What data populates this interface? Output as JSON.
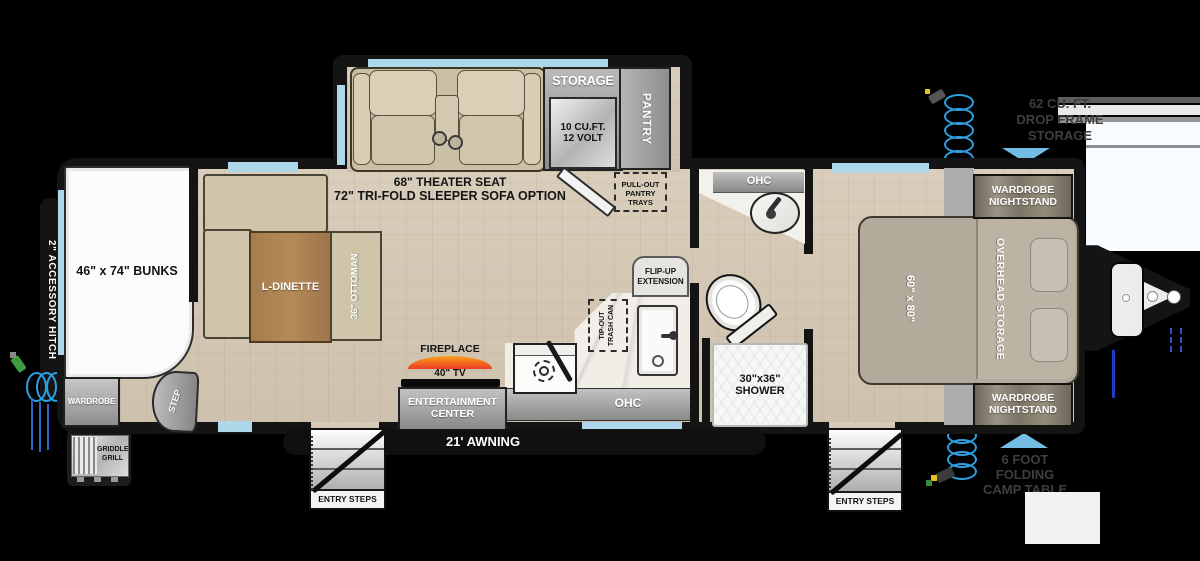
{
  "title": "Travel trailer floor plan",
  "colors": {
    "background": "#000000",
    "wall": "#141414",
    "window_blue": "#aed7ea",
    "accent_blue": "#74bce4",
    "floor_wood": "#d5c9b7",
    "flame_orange": "#f9a11b",
    "flame_red": "#ee3b24"
  },
  "exterior": {
    "accessory_hitch": "2\" ACCESSORY HITCH",
    "griddle_l1": "GRIDDLE",
    "griddle_l2": "GRILL",
    "awning": "21' AWNING",
    "entry_steps": "ENTRY STEPS",
    "drop_frame_l1": "62 CU. FT.",
    "drop_frame_l2": "DROP FRAME",
    "drop_frame_l3": "STORAGE",
    "camp_table_l1": "6 FOOT",
    "camp_table_l2": "FOLDING",
    "camp_table_l3": "CAMP TABLE"
  },
  "front_room": {
    "bunks": "46\" x 74\" BUNKS",
    "wardrobe": "WARDROBE",
    "step": "STEP",
    "dinette": "L-DINETTE",
    "ottoman": "36\" OTTOMAN"
  },
  "living": {
    "theater_l1": "68\" THEATER SEAT",
    "theater_l2": "72\" TRI-FOLD SLEEPER SOFA OPTION",
    "storage": "STORAGE",
    "fridge_l1": "10 CU.FT.",
    "fridge_l2": "12 VOLT",
    "pantry": "PANTRY",
    "pullout_l1": "PULL-OUT",
    "pullout_l2": "PANTRY",
    "pullout_l3": "TRAYS",
    "fireplace": "FIREPLACE",
    "tv": "40\" TV",
    "entertainment_l1": "ENTERTAINMENT",
    "entertainment_l2": "CENTER"
  },
  "kitchen": {
    "ohc": "OHC",
    "flip_up_l1": "FLIP-UP",
    "flip_up_l2": "EXTENSION",
    "trash_l1": "TIP-OUT",
    "trash_l2": "TRASH CAN"
  },
  "bathroom": {
    "ohc": "OHC",
    "shower_l1": "30\"x36\"",
    "shower_l2": "SHOWER"
  },
  "bedroom": {
    "bed_size": "60\" x 80\"",
    "overhead": "OVERHEAD STORAGE",
    "nightstand_l1": "WARDROBE",
    "nightstand_l2": "NIGHTSTAND"
  }
}
